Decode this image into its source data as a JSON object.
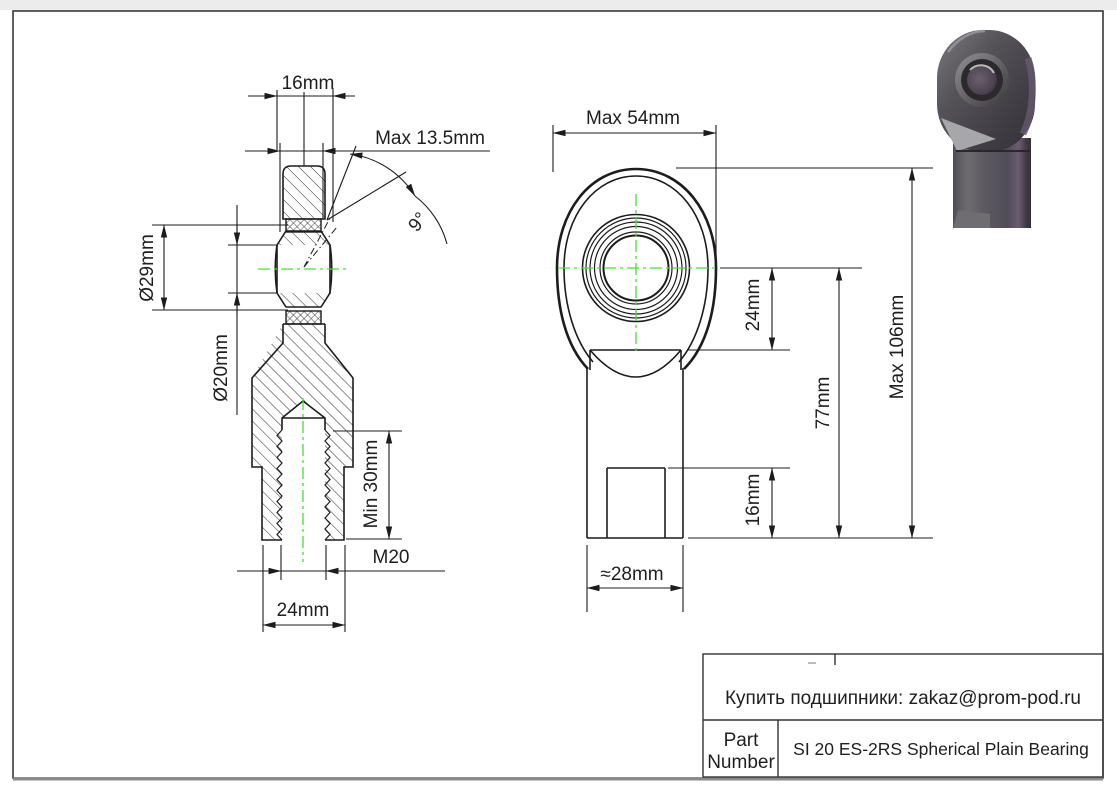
{
  "drawing": {
    "left_view": {
      "dim_housing_width": "16mm",
      "dim_max_width": "Max 13.5mm",
      "dim_misalignment_angle": "9°",
      "dim_outer_diameter": "Ø29mm",
      "dim_bore_diameter": "Ø20mm",
      "dim_thread_depth": "Min 30mm",
      "dim_thread_size": "M20",
      "dim_across_flats": "24mm"
    },
    "right_view": {
      "dim_head_width": "Max 54mm",
      "dim_center_to_shoulder": "24mm",
      "dim_shoulder_to_end": "77mm",
      "dim_total_length": "Max 106mm",
      "dim_flat_section": "16mm",
      "dim_shank_width": "≈28mm"
    },
    "title_block": {
      "contact_line": "Купить подшипники: zakaz@prom-pod.ru",
      "part_number_label_line1": "Part",
      "part_number_label_line2": "Number",
      "part_number_value": "SI 20 ES-2RS Spherical Plain Bearing"
    },
    "colors": {
      "line": "#1c1c1c",
      "centerline_green": "#49dd3a",
      "render_body_gray": "#46434a",
      "render_purple_tint": "#675a6e",
      "page_border_gray": "#8a8a8a"
    }
  }
}
